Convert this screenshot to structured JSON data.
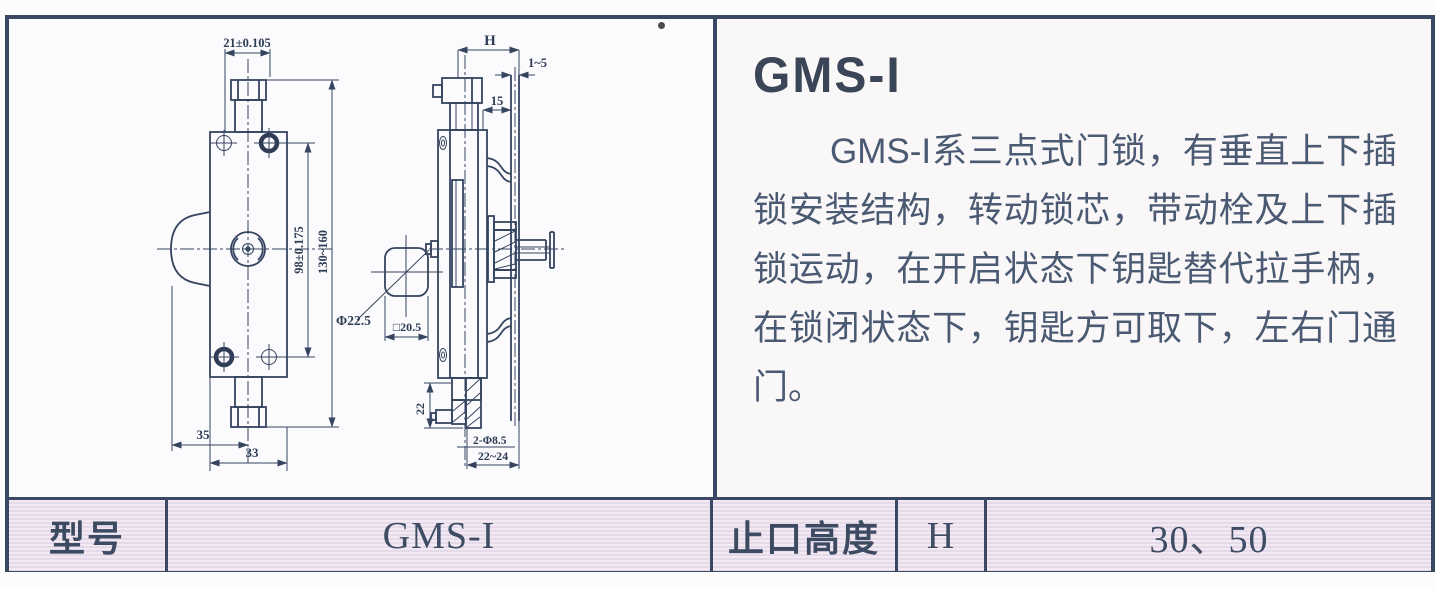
{
  "doc": {
    "title": "GMS-I",
    "description": "GMS-I系三点式门锁，有垂直上下插锁安装结构，转动锁芯，带动栓及上下插锁运动，在开启状态下钥匙替代拉手柄，在锁闭状态下，钥匙方可取下，左右门通门。"
  },
  "drawing": {
    "dims": {
      "top_width": "21±0.105",
      "hole_spacing": "98±0.175",
      "overall_length": "130~160",
      "offset_left": "35",
      "body_width": "33",
      "cylinder_diameter": "Φ22.5",
      "square_size": "□20.5",
      "rabbet_height": "H",
      "door_thickness": "1~5",
      "face_depth": "15",
      "bottom_length": "22",
      "mount_holes": "2-Φ8.5",
      "hole_pitch": "22~24"
    }
  },
  "spec_table": {
    "model_label": "型号",
    "model_value": "GMS-I",
    "height_label": "止口高度",
    "height_symbol": "H",
    "height_values": "30、50"
  },
  "colors": {
    "frame_border": "#3b4864",
    "line_color": "#35445f",
    "text_color": "#4a5a72",
    "table_stripe_light": "#f2e9f3",
    "table_stripe_dark": "#e5daea"
  }
}
